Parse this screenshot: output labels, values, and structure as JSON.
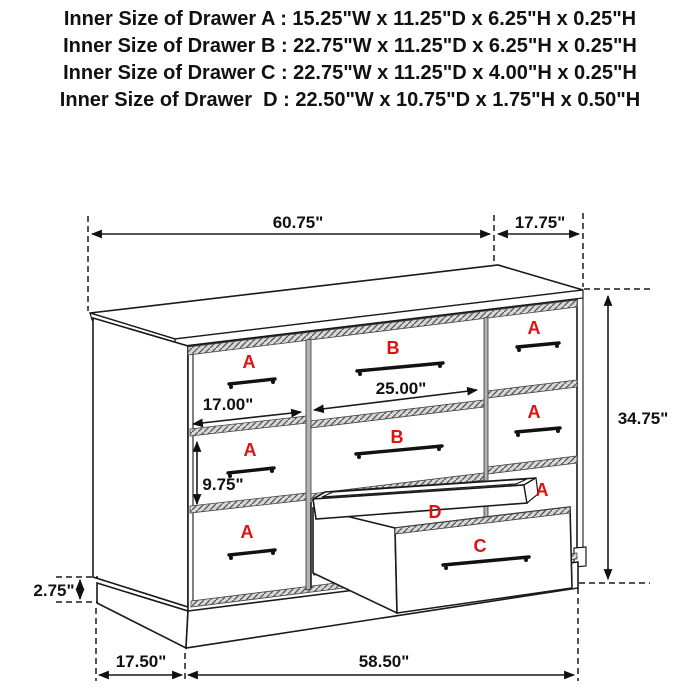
{
  "header": {
    "lines": [
      "Inner Size of Drawer A : 15.25\"W x 11.25\"D x 6.25\"H x 0.25\"H",
      "Inner Size of Drawer B : 22.75\"W x 11.25\"D x 6.25\"H x 0.25\"H",
      "Inner Size of Drawer C : 22.75\"W x 11.25\"D x 4.00\"H x 0.25\"H",
      "Inner Size of Drawer  D : 22.50\"W x 10.75\"D x 1.75\"H x 0.50\"H"
    ]
  },
  "diagram": {
    "labels": {
      "a": "A",
      "b": "B",
      "c": "C",
      "d": "D"
    },
    "dimensions": {
      "overall_width": "60.75\"",
      "overall_depth": "17.75\"",
      "overall_height": "34.75\"",
      "drawer_b_front_width": "25.00\"",
      "drawer_a_front_width": "17.00\"",
      "drawer_a_front_height": "9.75\"",
      "base_height": "2.75\"",
      "base_side_depth": "17.50\"",
      "base_front_width": "58.50\""
    }
  },
  "colors": {
    "label_red": "#e01010",
    "line": "#1a1a1a",
    "hatch_gray": "#d8d8d8",
    "background": "#ffffff"
  }
}
